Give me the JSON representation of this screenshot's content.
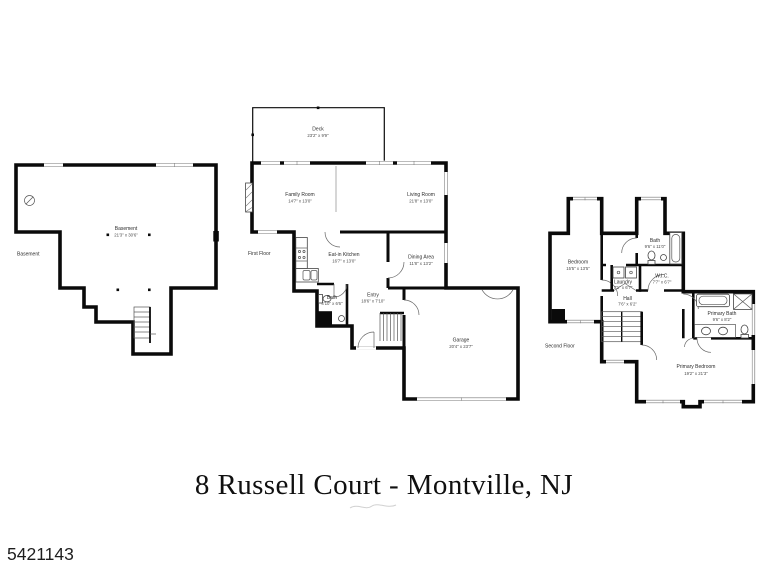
{
  "plans": {
    "basement": {
      "floor_label": "Basement",
      "room": {
        "name": "Basement",
        "dims": "21'3\" x 30'6\""
      }
    },
    "first_floor": {
      "floor_label": "First Floor",
      "deck": {
        "name": "Deck",
        "dims": "23'2\" x 9'9\""
      },
      "family_room": {
        "name": "Family Room",
        "dims": "14'7\" x 13'0\""
      },
      "living_room": {
        "name": "Living Room",
        "dims": "21'8\" x 13'0\""
      },
      "kitchen": {
        "name": "Eat-in Kitchen",
        "dims": "16'7\" x 13'0\""
      },
      "dining": {
        "name": "Dining Area",
        "dims": "11'8\" x 13'2\""
      },
      "bath": {
        "name": "Bath",
        "dims": "4'10\" x 6'6\""
      },
      "entry": {
        "name": "Entry",
        "dims": "18'6\" x 7'10\""
      },
      "garage": {
        "name": "Garage",
        "dims": "20'4\" x 23'7\""
      }
    },
    "second_floor": {
      "floor_label": "Second Floor",
      "bedroom": {
        "name": "Bedroom",
        "dims": "15'5\" x 13'5\""
      },
      "bath": {
        "name": "Bath",
        "dims": "9'6\" x 11'0\""
      },
      "laundry": {
        "name": "Laundry",
        "dims": "7'1\" x 6'7\""
      },
      "wic": {
        "name": "W.I.C.",
        "dims": "7'7\" x 6'7\""
      },
      "hall": {
        "name": "Hall",
        "dims": "7'6\" x 6'2\""
      },
      "primary_bath": {
        "name": "Primary Bath",
        "dims": "9'6\" x 8'2\""
      },
      "primary_bedroom": {
        "name": "Primary Bedroom",
        "dims": "19'2\" x 21'3\""
      }
    }
  },
  "footer": {
    "title": "8 Russell Court - Montville, NJ"
  },
  "watermark": {
    "id": "5421143"
  },
  "colors": {
    "wall": "#0a0a0a",
    "thin_line": "#555555",
    "label": "#2d2d2d"
  }
}
